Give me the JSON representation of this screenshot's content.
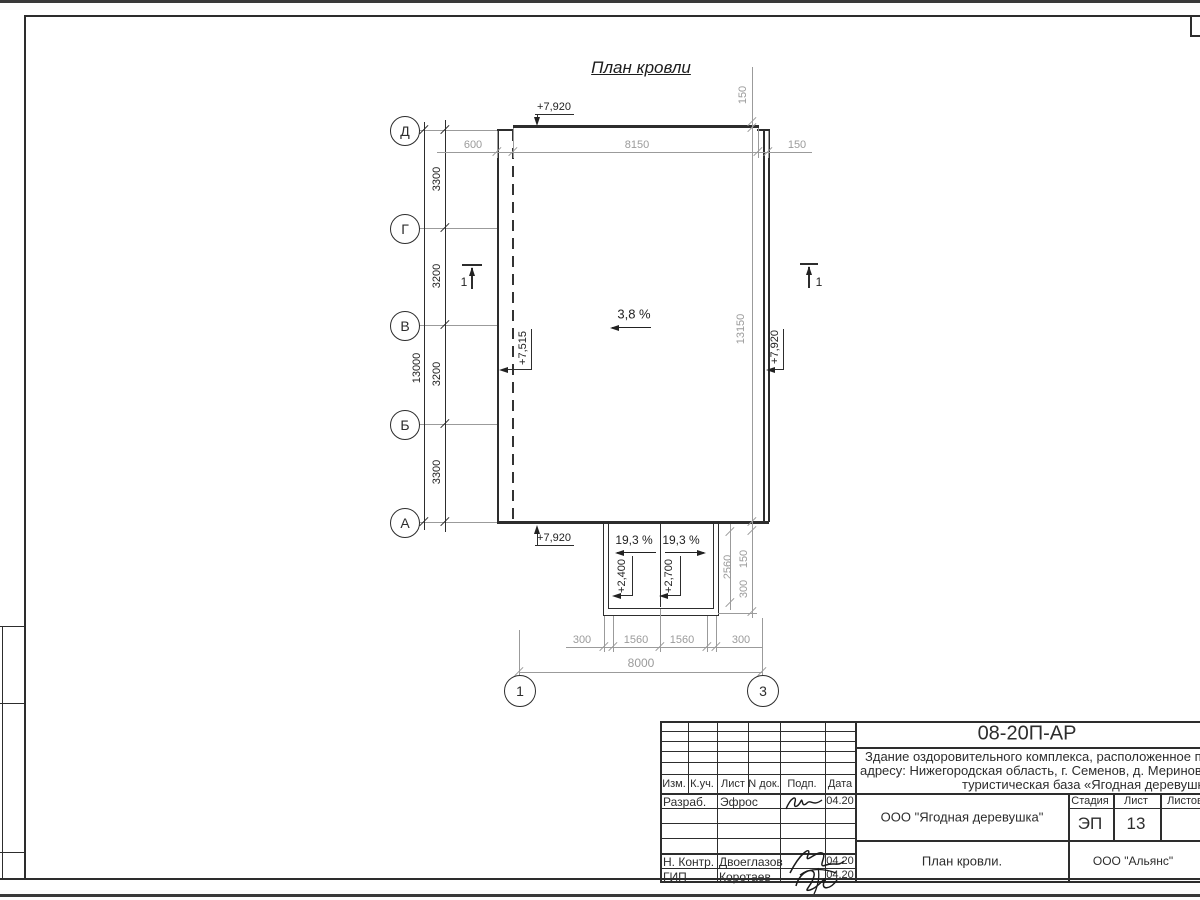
{
  "sheet": {
    "drawing_title": "План кровли"
  },
  "colors": {
    "ink": "#2d2d2d",
    "dim_lines": "#9b9b9b",
    "paper": "#ffffff"
  },
  "plan": {
    "slope_main": "3,8 %",
    "slope_porch_left": "19,3 %",
    "slope_porch_right": "19,3 %",
    "elev_top": "+7,920",
    "elev_bottom": "+7,920",
    "elev_right": "+7,920",
    "elev_inner_left": "+7,515",
    "elev_porch_left": "+2,400",
    "elev_porch_right": "+2,700",
    "section_mark_left": "1",
    "section_mark_right": "1",
    "row_axes": [
      "Д",
      "Г",
      "В",
      "Б",
      "А"
    ],
    "col_axes": [
      "1",
      "3"
    ],
    "dim_left_segments": [
      "3300",
      "3200",
      "3200",
      "3300"
    ],
    "dim_left_total": "13000",
    "dim_top": [
      "600",
      "8150",
      "150"
    ],
    "dim_right_top": "150",
    "dim_right_total": "13150",
    "dim_porch_side": [
      "2560",
      "150",
      "300"
    ],
    "dim_bottom_segments": [
      "300",
      "1560",
      "1560",
      "300"
    ],
    "dim_bottom_total": "8000"
  },
  "titleblock": {
    "doc_number": "08-20П-АР",
    "description_line1": "Здание оздоровительного комплекса, расположенное п",
    "description_line2": "адресу: Нижегородская область, г. Семенов, д. Меринов",
    "description_line3": "туристическая база «Ягодная деревушка»",
    "header_cols": [
      "Изм.",
      "К.уч.",
      "Лист",
      "N док.",
      "Подп.",
      "Дата"
    ],
    "rows": [
      {
        "role": "Разраб.",
        "name": "Эфрос",
        "date": "04.20"
      },
      {
        "role": "Н. Контр.",
        "name": "Двоеглазов",
        "date": "04.20"
      },
      {
        "role": "ГИП",
        "name": "Коротаев",
        "date": "04.20"
      }
    ],
    "org_customer": "ООО \"Ягодная деревушка\"",
    "stage_label": "Стадия",
    "sheet_label": "Лист",
    "sheets_label": "Листов",
    "stage_value": "ЭП",
    "sheet_value": "13",
    "sheet_title": "План кровли.",
    "org_contractor": "ООО \"Альянс\""
  }
}
